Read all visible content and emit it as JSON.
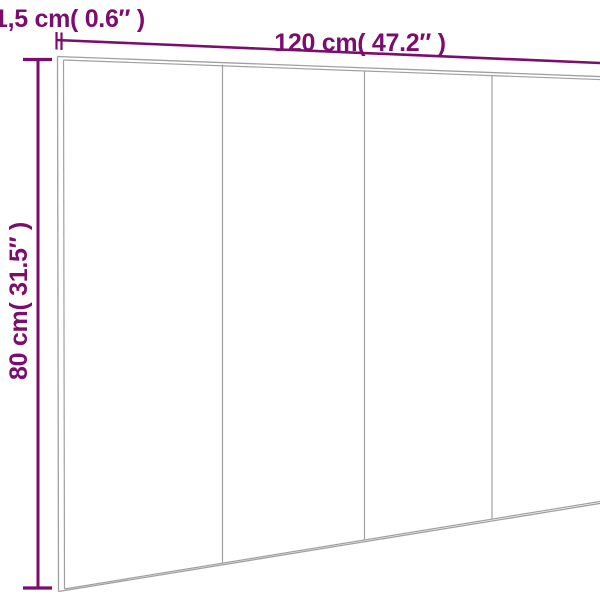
{
  "page": {
    "background": "#ffffff"
  },
  "diagram": {
    "kind": "product dimension diagram - headboard panel shown in slight perspective, front view, cropped at right edge",
    "panel": {
      "sections": 4,
      "outline_color": "#a0a0a0",
      "fill": "#ffffff",
      "seam_positions_px": [
        222,
        364,
        492
      ]
    },
    "dimensions": {
      "accent_color": "#7b0e6d",
      "thickness": {
        "label": "1,5 cm( 0.6″ )",
        "value_cm": 1.5,
        "value_inch": 0.6
      },
      "width": {
        "label": "120 cm( 47.2″ )",
        "value_cm": 120,
        "value_inch": 47.2
      },
      "height": {
        "label": "80 cm( 31.5″ )",
        "value_cm": 80,
        "value_inch": 31.5
      }
    }
  }
}
